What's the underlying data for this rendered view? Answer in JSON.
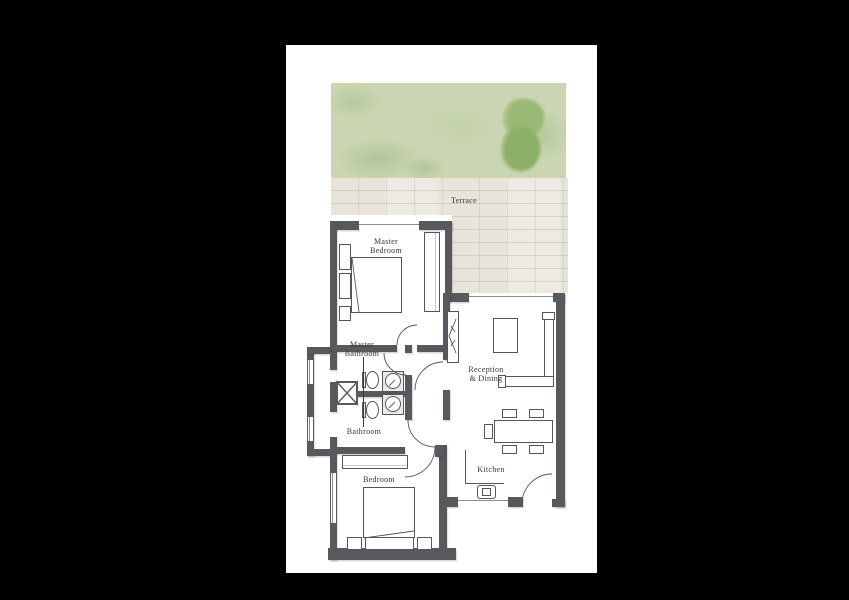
{
  "document": {
    "kind": "apartment-floor-plan",
    "description": "One-bedroom-plus-master unit floor plan with terrace and garden"
  },
  "labels": {
    "terrace": "Terrace",
    "master_bedroom": [
      "Master",
      "Bedroom"
    ],
    "master_bathroom": [
      "Master",
      "Bathroom"
    ],
    "bathroom": "Bathroom",
    "reception_dining": [
      "Reception",
      "& Dining"
    ],
    "kitchen": "Kitchen",
    "bedroom": "Bedroom"
  },
  "colors": {
    "background": "#000000",
    "paper": "#ffffff",
    "wall": "#58595d",
    "furniture_line": "#55565a",
    "label_text": "#35353c",
    "garden_green": "#c9d6b1",
    "tree_green": "#8fb46b",
    "paving": "#edeae3"
  }
}
